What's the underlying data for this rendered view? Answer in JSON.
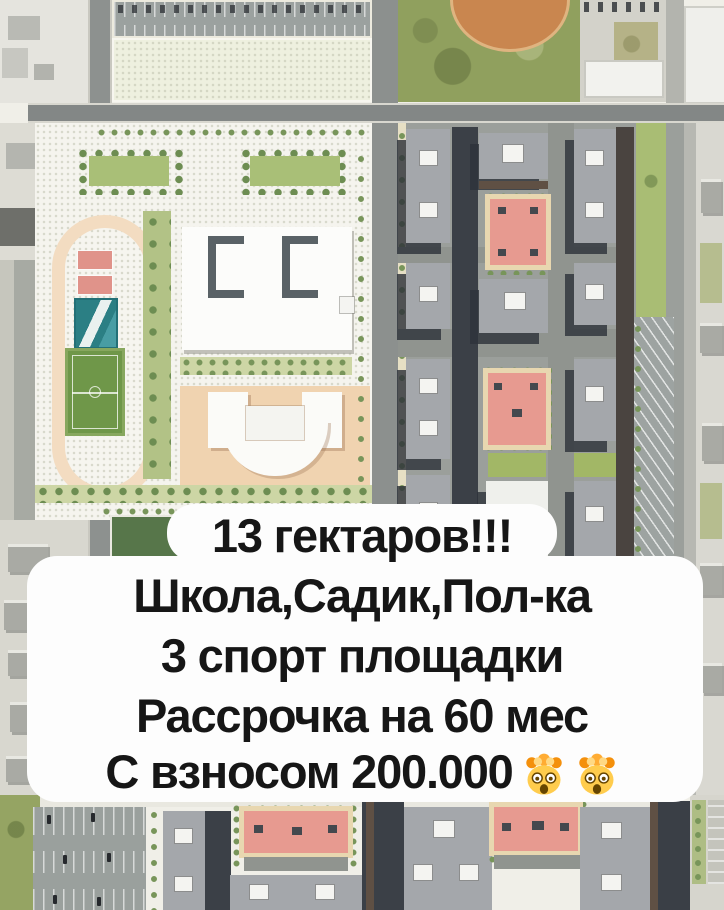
{
  "overlay": {
    "line1": "13 гектаров!!!",
    "line2": "Школа,Садик,Пол-ка",
    "line3": "3 спорт площадки",
    "line4": "Рассрочка на 60 мес",
    "line5": "С взносом 200.000",
    "line5_emoji": "🤯🤯",
    "emoji_icon": "exploding-head",
    "emoji_count": 2,
    "text_color": "#161616",
    "bubble_color": "#fdfdfd"
  },
  "site_plan": {
    "type": "aerial-masterplan-render",
    "palette": {
      "road": "#8d918f",
      "campus_ground": "#f5f4ee",
      "running_track": "#f3dcc1",
      "football_field": "#6f9749",
      "basketball_court": "#2b7f84",
      "red_courts": "#e79a90",
      "court_frame_tan": "#e8d7b0",
      "lawns": "#a9bd74",
      "trees": "#78955a",
      "apartment_roofs": "#a4a7ab",
      "building_shadows": "#3b4047",
      "school_building": "#fcfcfa",
      "kindergarten_plot": "#f0d3b0",
      "photo_grass": "#90a05e",
      "baseball_infield": "#c9864f",
      "parking": "#9aa09d",
      "surrounding_aerial": "#d9d8d1"
    }
  }
}
